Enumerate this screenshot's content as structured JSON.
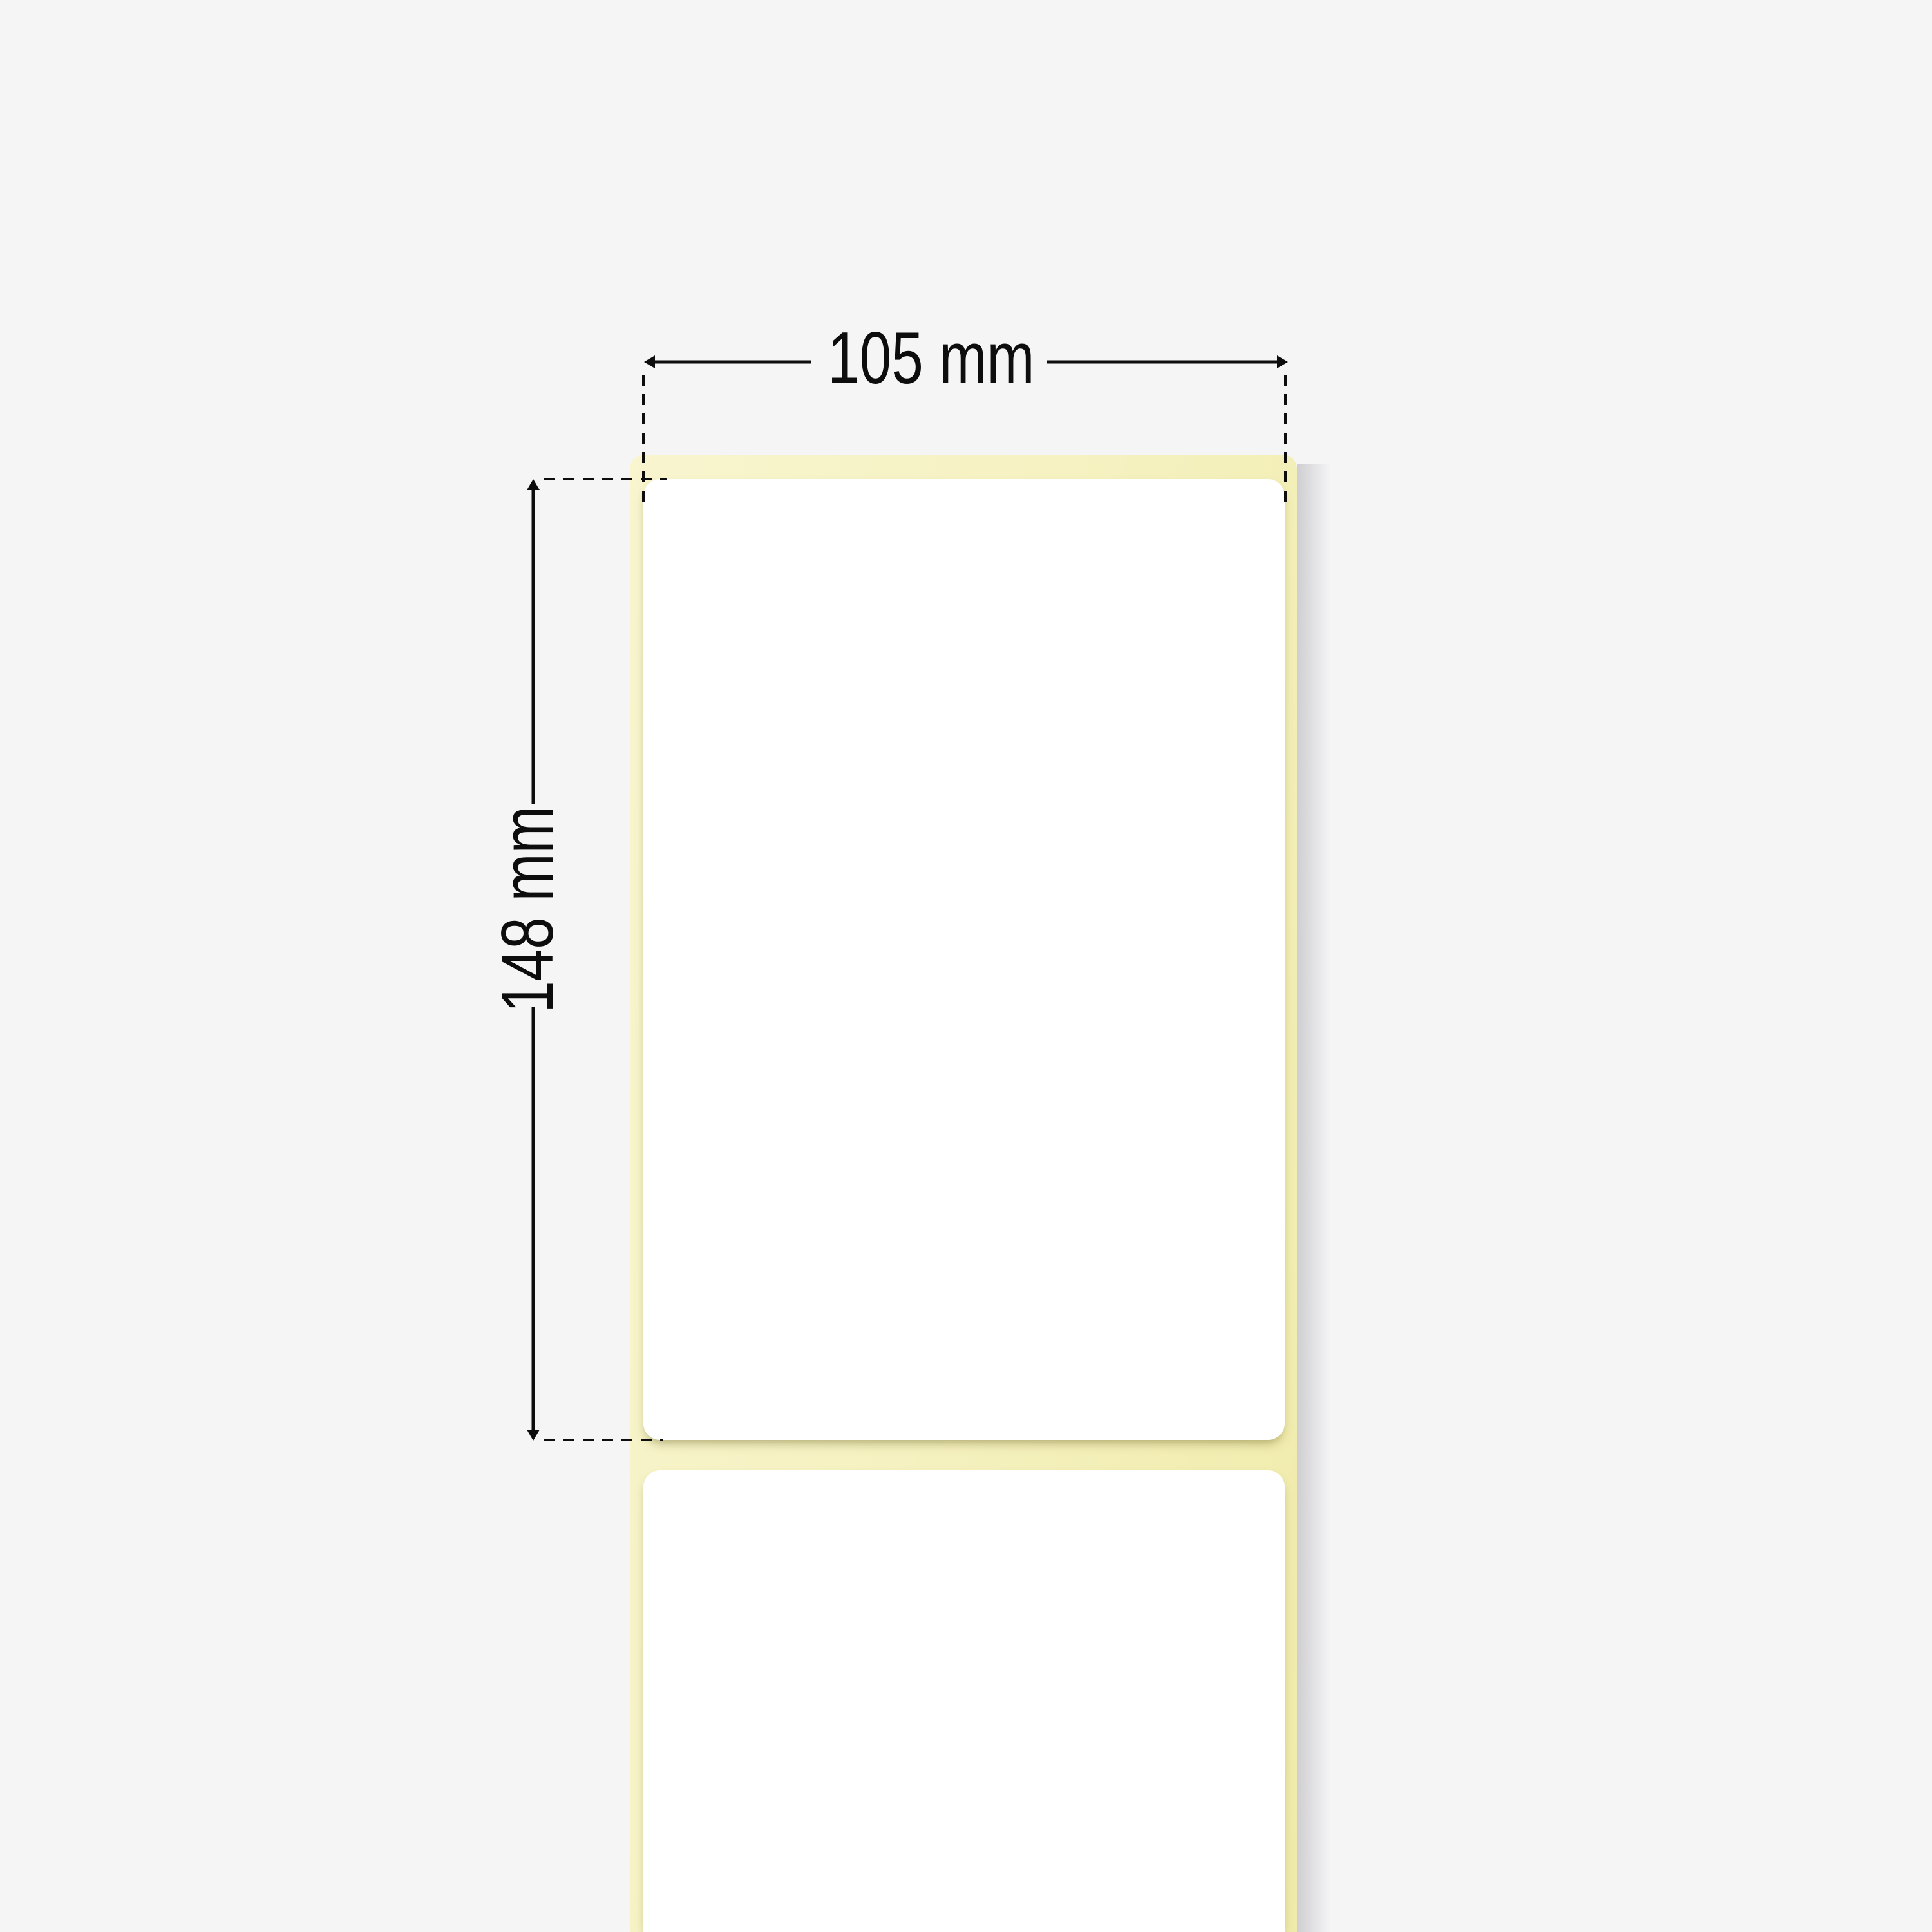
{
  "diagram": {
    "kind": "label-roll-dimension-illustration",
    "width_dimension": {
      "label": "105 mm"
    },
    "height_dimension": {
      "label": "148 mm"
    }
  },
  "colors": {
    "background": "#f5f5f6",
    "liner_yellow": "#f5f1bf",
    "liner_yellow_light": "#f8f5cf",
    "liner_yellow_dark": "#f0ebaa",
    "label_white": "#ffffff",
    "annotation_black": "#0d0d0d"
  }
}
